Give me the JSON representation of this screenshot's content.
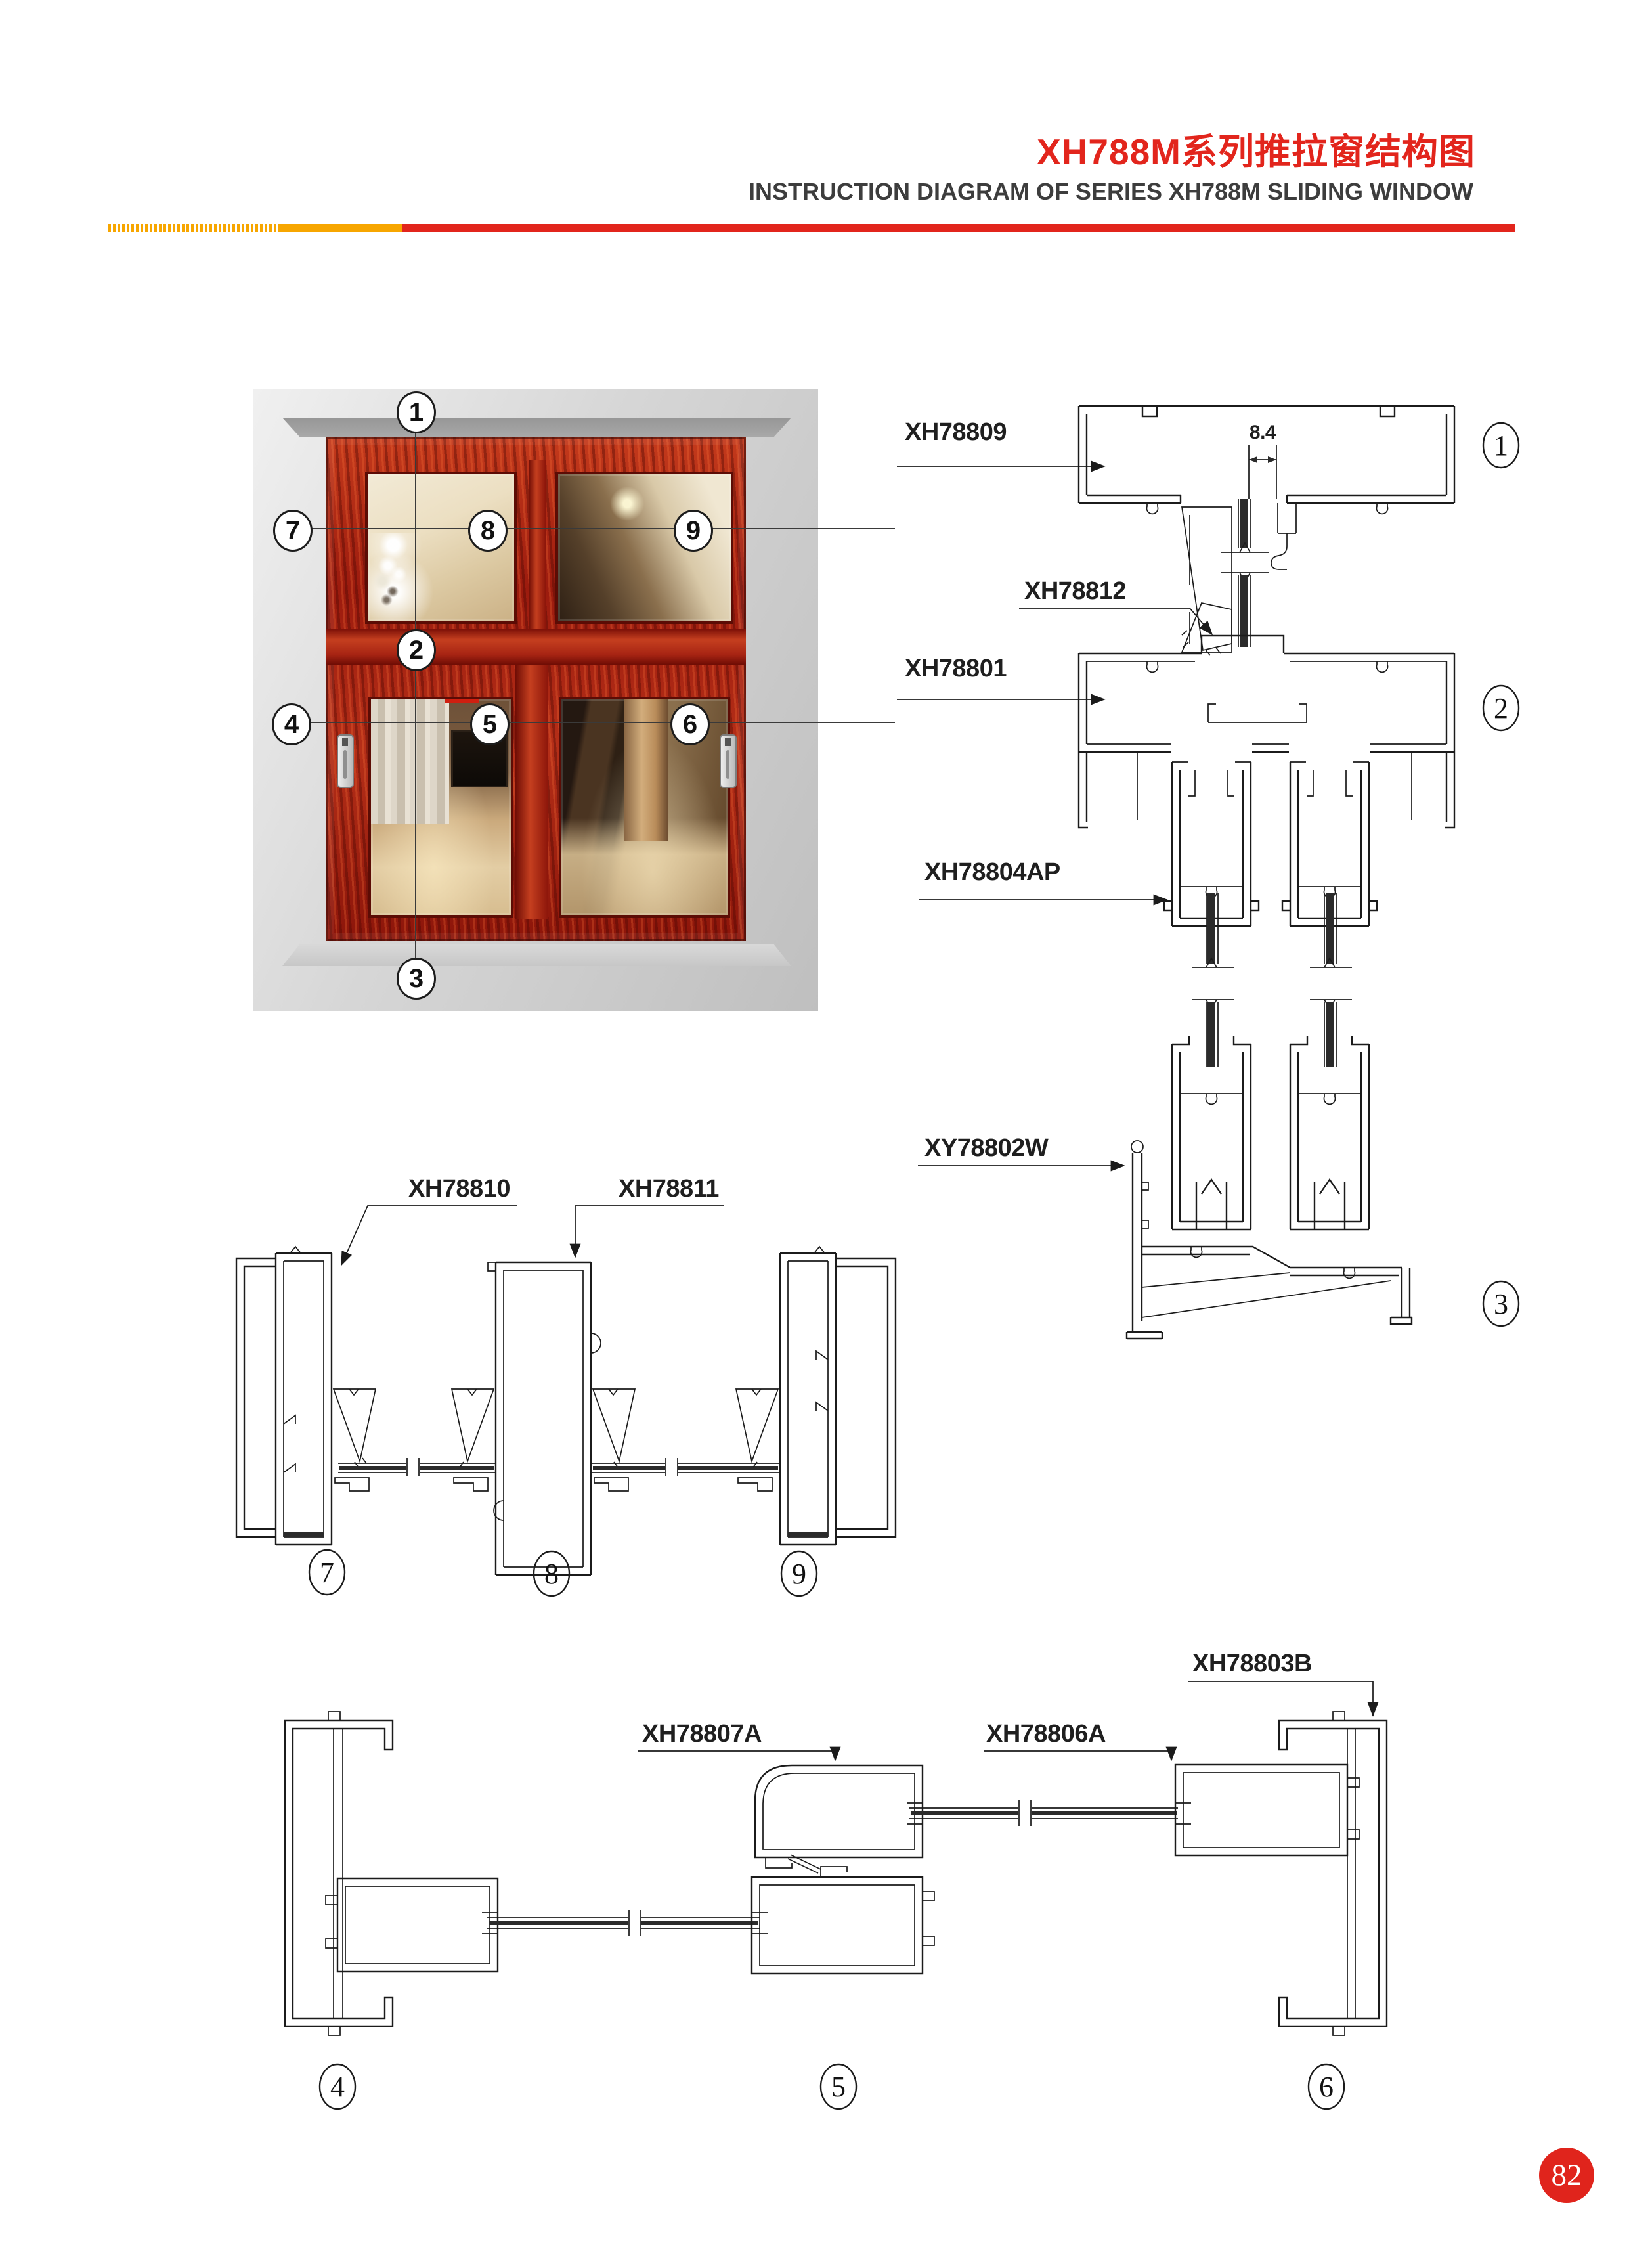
{
  "header": {
    "title_zh": "XH788M系列推拉窗结构图",
    "title_en": "INSTRUCTION DIAGRAM OF SERIES XH788M SLIDING WINDOW"
  },
  "page_number": "82",
  "colors": {
    "accent_red": "#e2251c",
    "accent_yellow": "#f7a600",
    "line": "#1b1b1b"
  },
  "photo": {
    "callouts": [
      "1",
      "2",
      "3",
      "4",
      "5",
      "6",
      "7",
      "8",
      "9"
    ]
  },
  "sections": {
    "vertical": {
      "dimension": "8.4",
      "labels": [
        "XH78809",
        "XH78812",
        "XH78801",
        "XH78804AP",
        "XY78802W"
      ],
      "callouts": [
        "1",
        "2",
        "3"
      ]
    },
    "transom": {
      "labels": [
        "XH78810",
        "XH78811"
      ],
      "callouts": [
        "7",
        "8",
        "9"
      ]
    },
    "sash": {
      "labels": [
        "XH78807A",
        "XH78806A",
        "XH78803B"
      ],
      "callouts": [
        "4",
        "5",
        "6"
      ]
    }
  }
}
